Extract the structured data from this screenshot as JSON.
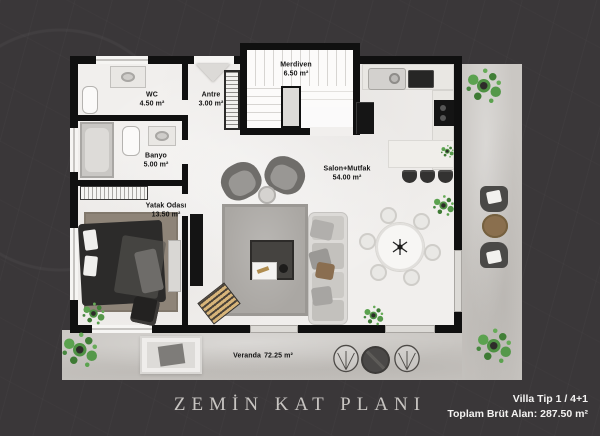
{
  "plan": {
    "title": "ZEMİN KAT PLANI",
    "info": {
      "villa_type": "Villa Tip 1 / 4+1",
      "total_area": "Toplam Brüt Alan: 287.50 m²"
    },
    "rooms": [
      {
        "id": "merdiven",
        "name": "Merdiven",
        "area": "6.50 m²"
      },
      {
        "id": "wc",
        "name": "WC",
        "area": "4.50 m²"
      },
      {
        "id": "antre",
        "name": "Antre",
        "area": "3.00 m²"
      },
      {
        "id": "banyo",
        "name": "Banyo",
        "area": "5.00 m²"
      },
      {
        "id": "yatak-odasi",
        "name": "Yatak Odası",
        "area": "13.50 m²"
      },
      {
        "id": "salon-mutfak",
        "name": "Salon+Mutfak",
        "area": "54.00 m²"
      },
      {
        "id": "veranda",
        "name": "Veranda",
        "area": "72.25 m²"
      }
    ],
    "colors": {
      "background": "#3a3739",
      "wall": "#101010",
      "floor": "#f1efed",
      "veranda_floor": "#cac7c3",
      "plant_green": "#4e9143",
      "title_text": "#c8c5c2",
      "label_text": "#141414"
    }
  }
}
